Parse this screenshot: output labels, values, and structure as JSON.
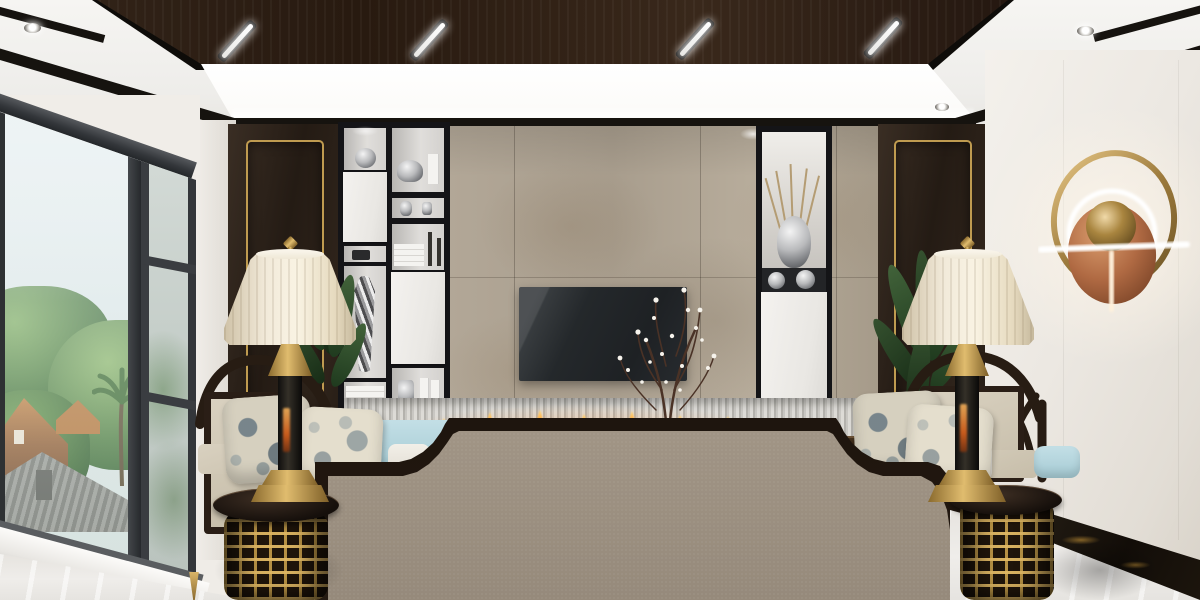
{
  "image": {
    "kind": "photorealistic interior 3D render, no visible text or UI",
    "room": "modern Chinese (new-Chinese) style living room, view toward TV feature wall",
    "width_px": 1200,
    "height_px": 600
  },
  "palette": {
    "ceiling_wood": "#2e2014",
    "cove_light": "#ffffff",
    "trim_black": "#16130f",
    "wall_white": "#efece7",
    "wall_dark_wood_panel": "#2b211a",
    "gold_trim": "#bf9b50",
    "concrete_feature_wall": "#afa494",
    "shelf_frame_black": "#141417",
    "cabinet_door_white": "#f0eeeb",
    "tv_screen": "#24272a",
    "fireplace_flame": "#ff8c2a",
    "ribbed_strip": "#c9c7c2",
    "teal_vase": "#3aaea6",
    "sofa_fabric_taupe": "#a89c8d",
    "sofa_wood_trim": "#241a12",
    "chair_upholstery_beige": "#d2c9b6",
    "seat_cushion_blue": "#b7d8e0",
    "lamp_shade_cream": "#f0e8d5",
    "brass_gold": "#c39a4d",
    "sconce_copper_disc": "#bd7e55",
    "plant_green": "#2f4a2b",
    "floor_marble_white": "#eceae6",
    "baseboard_black_marble": "#1a150f",
    "window_frame": "#35383b",
    "sky_haze": "#e6eef0",
    "foliage_outside": "#4c7a43",
    "roof_tan": "#b5793f"
  },
  "scene": {
    "ceiling": [
      {
        "name": "dark-wood-drop-panel",
        "desc": "walnut ceiling panel, trapezoid in perspective"
      },
      {
        "name": "linear-led-slots",
        "count": 4,
        "desc": "slanted recessed white linear lights in wood panel"
      },
      {
        "name": "perimeter-cove-light",
        "desc": "bright white cove band around wood panel"
      },
      {
        "name": "black-trim-bands",
        "desc": "black reveal trims, sloped toward corners"
      },
      {
        "name": "round-downlights",
        "count": 4
      }
    ],
    "left_side": [
      {
        "name": "floor-to-ceiling-window",
        "parts": [
          "large clear pane",
          "dark mullion",
          "frosted casement with 3 panes",
          "white sloped sill"
        ]
      },
      {
        "name": "outside-view",
        "items": [
          "hazy bright sky",
          "dense green trees",
          "palm tree",
          "tan gabled roof house",
          "gray tiled roofs"
        ]
      },
      {
        "name": "dark-wood-accent-panel-left",
        "desc": "espresso panel with inset gold frame"
      }
    ],
    "center": [
      {
        "name": "black-display-shelving-left",
        "items": [
          "glass sphere",
          "white cabinet doors",
          "spiral striped vase",
          "white books",
          "silver teapot",
          "candlesticks",
          "silver cups"
        ]
      },
      {
        "name": "concrete-panel-tv-wall",
        "desc": "large beige-gray cement panels with seams"
      },
      {
        "name": "wall-mounted-tv",
        "desc": "dark blank screen"
      },
      {
        "name": "blossom-branch-in-teal-vase",
        "desc": "dark twigs with small white blossoms, teal round vase"
      },
      {
        "name": "display-niche-right",
        "items": [
          "silver mercury vase with dried twigs",
          "two silver orbs",
          "white cabinet"
        ]
      },
      {
        "name": "linear-fireplace",
        "desc": "ribbed fluted strip with row of small orange flames"
      },
      {
        "name": "dark-wood-console-ledge"
      }
    ],
    "right_side": [
      {
        "name": "dark-wood-accent-panel-right",
        "desc": "espresso panel with inset gold frame"
      },
      {
        "name": "white-marble-wall",
        "desc": "large light wall panels"
      },
      {
        "name": "wall-sconce",
        "parts": [
          "brass oval ring",
          "glowing white halo ring",
          "horizontal white LED bar",
          "copper disc",
          "brass sphere",
          "vertical glowing stem"
        ]
      },
      {
        "name": "black-gold-marble-baseboard",
        "desc": "sloped skirting along right wall"
      }
    ],
    "furniture": [
      {
        "name": "sofa-back",
        "desc": "taupe fabric back panel with dark wood trim, stepped concave shoulders"
      },
      {
        "name": "armchair-left",
        "parts": [
          "curved dark crest rail",
          "beige panels",
          "two floral pillows",
          "blue seat cushions",
          "white cushion",
          "gold-tipped leg"
        ]
      },
      {
        "name": "armchair-right",
        "parts": [
          "curved crest rail with fretwork",
          "beige panels",
          "two floral pillows",
          "blue seat cushions",
          "white cushion"
        ]
      },
      {
        "name": "side-table-left",
        "desc": "drum table, gold Chinese lattice base, dark top"
      },
      {
        "name": "side-table-right",
        "desc": "drum table, gold Chinese lattice base, dark top"
      },
      {
        "name": "table-lamp-left",
        "parts": [
          "cream pleated bell shade",
          "gold finial",
          "brass neck",
          "dark marble column with fire reflection",
          "stepped brass base"
        ]
      },
      {
        "name": "table-lamp-right",
        "parts": [
          "cream pleated bell shade",
          "gold finial",
          "brass neck",
          "dark marble column with fire reflection",
          "stepped brass base"
        ]
      },
      {
        "name": "potted-plant-left"
      },
      {
        "name": "potted-plant-right"
      }
    ],
    "floor": [
      {
        "name": "white-polished-marble-floor",
        "desc": "glossy, window light reflections"
      }
    ]
  },
  "interactable_elements": 0
}
